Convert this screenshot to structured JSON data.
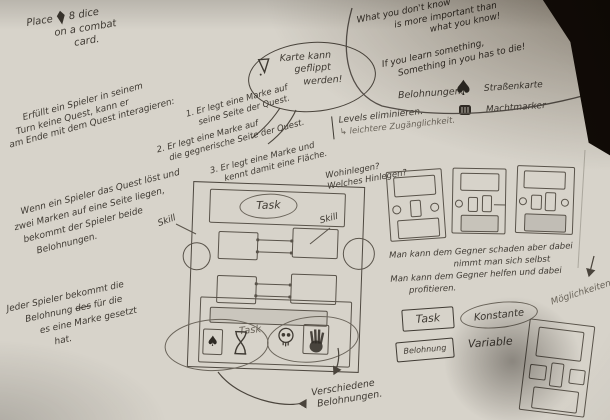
{
  "photo": {
    "colors": {
      "paper": "#d7d3ca",
      "ink": "#3f3a33",
      "pencil": "#6a645a",
      "shadow_corner": "#1b130b"
    }
  },
  "top_left_note": {
    "word_place": "Place",
    "word_dice": "8 dice",
    "line2": "on a combat",
    "line3": "card."
  },
  "quotes": {
    "q1_l1": "What you don't know",
    "q1_l2": "is more important than",
    "q1_l3": "what you know!",
    "q2_l1": "If you learn something,",
    "q2_l2": "Something in you has to die!"
  },
  "bubble": {
    "l1": "Karte kann",
    "l2": "geflippt",
    "l3": "werden!"
  },
  "rewards": {
    "title": "Belohnungen:",
    "item1": "Straßenkarte",
    "item2": "Machtmarker"
  },
  "rules": {
    "intro_l1": "Erfüllt ein Spieler in seinem",
    "intro_l2": "Turn keine Quest, kann er",
    "intro_l3": "am Ende mit dem Quest interagieren:",
    "s1_l1": "1. Er legt eine Marke auf",
    "s1_l2": "seine Seite der Quest.",
    "s2_l1": "2. Er legt eine Marke auf",
    "s2_l2": "die gegnerische Seite der Quest.",
    "s3_l1": "3. Er legt eine Marke und",
    "s3_l2": "kennt damit eine Fläche."
  },
  "levels": {
    "l1": "Levels eliminieren.",
    "l2": "↳ leichtere Zugänglichkeit."
  },
  "placement": {
    "l1": "Wohinlegen?",
    "l2": "Welches Hinlegen?"
  },
  "para_two_marks": {
    "l1": "Wenn ein Spieler das Quest löst und",
    "l2": "zwei Marken auf eine Seite liegen,",
    "l3": "bekommt der Spieler beide",
    "l4": "Belohnungen."
  },
  "para_each_player": {
    "l1": "Jeder Spieler bekommt die",
    "l2_pre": "Belohnung",
    "l2_strike": "des",
    "l2_post": "für die",
    "l3": "es eine Marke gesetzt",
    "l4": "hat."
  },
  "card": {
    "task_top": "Task",
    "task_bottom": "Task",
    "skill_left": "Skill",
    "skill_right": "Skill"
  },
  "opponent": {
    "l1": "Man kann dem Gegner schaden aber dabei",
    "l2": "nimmt man sich selbst",
    "l3": "Man kann dem Gegner helfen und dabei",
    "l4": "profitieren."
  },
  "side_note": {
    "moeglichkeiten": "Möglichkeiten"
  },
  "various": {
    "l1": "Verschiedene",
    "l2": "Belohnungen."
  },
  "legend": {
    "task": "Task",
    "konstante": "Konstante",
    "belohnung": "Belohnung",
    "variable": "Variable"
  }
}
